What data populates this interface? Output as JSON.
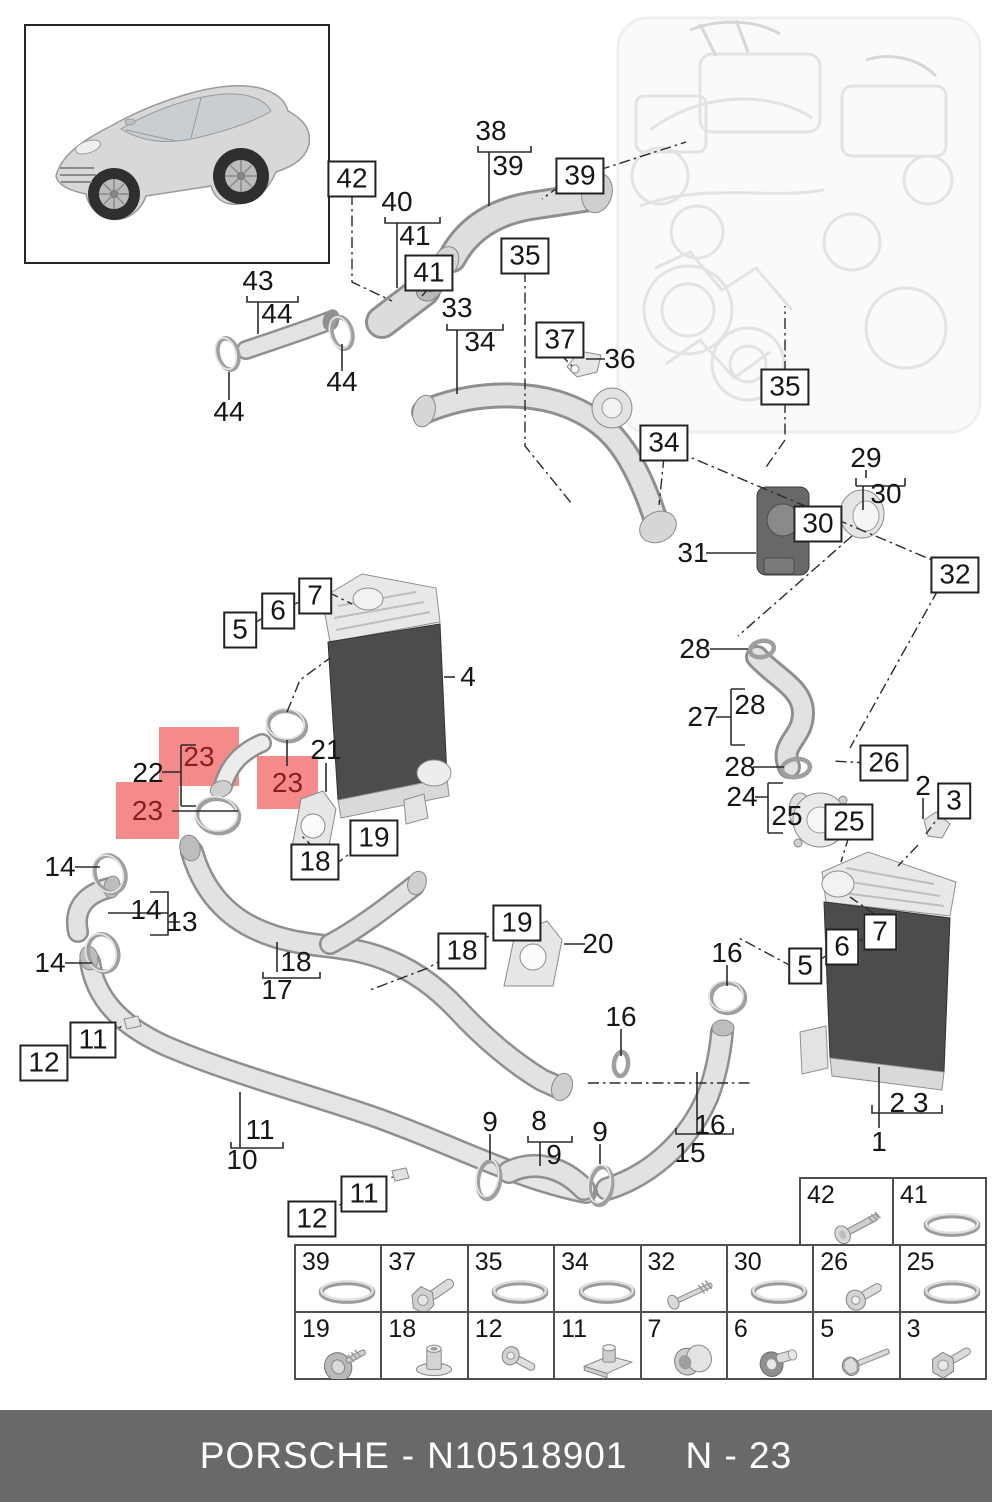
{
  "colors": {
    "highlight_fill": "#f48a8a",
    "highlight_text": "#8c1d1d",
    "callout_text": "#161616",
    "callout_box_border": "#222222",
    "table_border": "#4f4f4f",
    "footer_bg": "#696969",
    "footer_text": "#ffffff",
    "diagram_line": "#2b2b2b",
    "intercooler_core": "#4c4c4c"
  },
  "selected_part": "23",
  "footer": {
    "brand": "PORSCHE",
    "separator": "-",
    "part_number": "N10518901",
    "page_code": "N - 23"
  },
  "vehicle_thumbnail": {
    "description": "silver SUV three-quarter front view"
  },
  "callouts": [
    {
      "label": "42",
      "style": "boxed",
      "x": 352,
      "y": 179
    },
    {
      "label": "39",
      "style": "boxed",
      "x": 580,
      "y": 176
    },
    {
      "label": "41",
      "style": "boxed",
      "x": 429,
      "y": 273
    },
    {
      "label": "35",
      "style": "boxed",
      "x": 525,
      "y": 256
    },
    {
      "label": "37",
      "style": "boxed",
      "x": 560,
      "y": 340
    },
    {
      "label": "35",
      "style": "boxed",
      "x": 785,
      "y": 387
    },
    {
      "label": "34",
      "style": "boxed",
      "x": 664,
      "y": 443
    },
    {
      "label": "30",
      "style": "boxed",
      "x": 818,
      "y": 524
    },
    {
      "label": "32",
      "style": "boxed",
      "x": 955,
      "y": 575
    },
    {
      "label": "26",
      "style": "boxed",
      "x": 884,
      "y": 763
    },
    {
      "label": "25",
      "style": "boxed",
      "x": 849,
      "y": 822
    },
    {
      "label": "3",
      "style": "boxed",
      "x": 954,
      "y": 801
    },
    {
      "label": "5",
      "style": "boxed",
      "x": 240,
      "y": 630
    },
    {
      "label": "6",
      "style": "boxed",
      "x": 278,
      "y": 611
    },
    {
      "label": "7",
      "style": "boxed",
      "x": 315,
      "y": 596
    },
    {
      "label": "19",
      "style": "boxed",
      "x": 374,
      "y": 838
    },
    {
      "label": "18",
      "style": "boxed",
      "x": 315,
      "y": 862
    },
    {
      "label": "19",
      "style": "boxed",
      "x": 517,
      "y": 923
    },
    {
      "label": "18",
      "style": "boxed",
      "x": 462,
      "y": 951
    },
    {
      "label": "11",
      "style": "boxed",
      "x": 93,
      "y": 1040
    },
    {
      "label": "12",
      "style": "boxed",
      "x": 44,
      "y": 1063
    },
    {
      "label": "11",
      "style": "boxed",
      "x": 364,
      "y": 1194
    },
    {
      "label": "12",
      "style": "boxed",
      "x": 312,
      "y": 1219
    },
    {
      "label": "5",
      "style": "boxed",
      "x": 805,
      "y": 966
    },
    {
      "label": "6",
      "style": "boxed",
      "x": 842,
      "y": 947
    },
    {
      "label": "7",
      "style": "boxed",
      "x": 880,
      "y": 932
    },
    {
      "label": "38",
      "style": "plain",
      "x": 491,
      "y": 131
    },
    {
      "label": "39",
      "style": "plain",
      "x": 508,
      "y": 166
    },
    {
      "label": "40",
      "style": "plain",
      "x": 397,
      "y": 202
    },
    {
      "label": "41",
      "style": "plain",
      "x": 415,
      "y": 236
    },
    {
      "label": "43",
      "style": "plain",
      "x": 258,
      "y": 281
    },
    {
      "label": "44",
      "style": "plain",
      "x": 277,
      "y": 314
    },
    {
      "label": "44",
      "style": "plain",
      "x": 342,
      "y": 382
    },
    {
      "label": "44",
      "style": "plain",
      "x": 229,
      "y": 412
    },
    {
      "label": "33",
      "style": "plain",
      "x": 457,
      "y": 308
    },
    {
      "label": "34",
      "style": "plain",
      "x": 480,
      "y": 342
    },
    {
      "label": "36",
      "style": "plain",
      "x": 620,
      "y": 359
    },
    {
      "label": "29",
      "style": "plain",
      "x": 866,
      "y": 458
    },
    {
      "label": "30",
      "style": "plain",
      "x": 886,
      "y": 494
    },
    {
      "label": "31",
      "style": "plain",
      "x": 693,
      "y": 553
    },
    {
      "label": "28",
      "style": "plain",
      "x": 695,
      "y": 649
    },
    {
      "label": "28",
      "style": "plain",
      "x": 750,
      "y": 705
    },
    {
      "label": "27",
      "style": "plain",
      "x": 703,
      "y": 717
    },
    {
      "label": "28",
      "style": "plain",
      "x": 740,
      "y": 767
    },
    {
      "label": "24",
      "style": "plain",
      "x": 742,
      "y": 797
    },
    {
      "label": "25",
      "style": "plain",
      "x": 787,
      "y": 816
    },
    {
      "label": "2",
      "style": "plain",
      "x": 923,
      "y": 786
    },
    {
      "label": "4",
      "style": "plain",
      "x": 468,
      "y": 677
    },
    {
      "label": "21",
      "style": "plain",
      "x": 326,
      "y": 750
    },
    {
      "label": "22",
      "style": "plain",
      "x": 148,
      "y": 773
    },
    {
      "label": "14",
      "style": "plain",
      "x": 60,
      "y": 867
    },
    {
      "label": "14",
      "style": "plain",
      "x": 146,
      "y": 910
    },
    {
      "label": "13",
      "style": "plain",
      "x": 182,
      "y": 922
    },
    {
      "label": "14",
      "style": "plain",
      "x": 50,
      "y": 963
    },
    {
      "label": "18",
      "style": "plain",
      "x": 296,
      "y": 962
    },
    {
      "label": "17",
      "style": "plain",
      "x": 277,
      "y": 990
    },
    {
      "label": "20",
      "style": "plain",
      "x": 598,
      "y": 944
    },
    {
      "label": "16",
      "style": "plain",
      "x": 621,
      "y": 1017
    },
    {
      "label": "16",
      "style": "plain",
      "x": 727,
      "y": 953
    },
    {
      "label": "16",
      "style": "plain",
      "x": 710,
      "y": 1125
    },
    {
      "label": "15",
      "style": "plain",
      "x": 690,
      "y": 1153
    },
    {
      "label": "9",
      "style": "plain",
      "x": 490,
      "y": 1122
    },
    {
      "label": "8",
      "style": "plain",
      "x": 539,
      "y": 1121
    },
    {
      "label": "9",
      "style": "plain",
      "x": 554,
      "y": 1155
    },
    {
      "label": "9",
      "style": "plain",
      "x": 600,
      "y": 1132
    },
    {
      "label": "11",
      "style": "plain",
      "x": 260,
      "y": 1130
    },
    {
      "label": "10",
      "style": "plain",
      "x": 242,
      "y": 1160
    },
    {
      "label": "2 3",
      "style": "plain",
      "x": 909,
      "y": 1103
    },
    {
      "label": "1",
      "style": "plain",
      "x": 879,
      "y": 1142
    },
    {
      "label": "23",
      "style": "highlight",
      "x": 159,
      "y": 727,
      "w": 80,
      "h": 59
    },
    {
      "label": "23",
      "style": "highlight",
      "x": 257,
      "y": 756,
      "w": 61,
      "h": 53
    },
    {
      "label": "23",
      "style": "highlight",
      "x": 116,
      "y": 782,
      "w": 63,
      "h": 57
    }
  ],
  "hardware_table": {
    "top_row": [
      {
        "label": "42",
        "icon": "screw-washer-long"
      },
      {
        "label": "41",
        "icon": "o-ring"
      }
    ],
    "rows": [
      [
        {
          "label": "39",
          "icon": "o-ring"
        },
        {
          "label": "37",
          "icon": "bolt-hex"
        },
        {
          "label": "35",
          "icon": "o-ring"
        },
        {
          "label": "34",
          "icon": "o-ring"
        },
        {
          "label": "32",
          "icon": "screw-long-thin"
        },
        {
          "label": "30",
          "icon": "o-ring"
        },
        {
          "label": "26",
          "icon": "screw-pan"
        },
        {
          "label": "25",
          "icon": "o-ring"
        }
      ],
      [
        {
          "label": "19",
          "icon": "screw-washer"
        },
        {
          "label": "18",
          "icon": "bushing"
        },
        {
          "label": "12",
          "icon": "screw-pan-small"
        },
        {
          "label": "11",
          "icon": "clip-nut"
        },
        {
          "label": "7",
          "icon": "grommet"
        },
        {
          "label": "6",
          "icon": "mount-plug"
        },
        {
          "label": "5",
          "icon": "bolt-long"
        },
        {
          "label": "3",
          "icon": "bolt-flange"
        }
      ]
    ]
  }
}
